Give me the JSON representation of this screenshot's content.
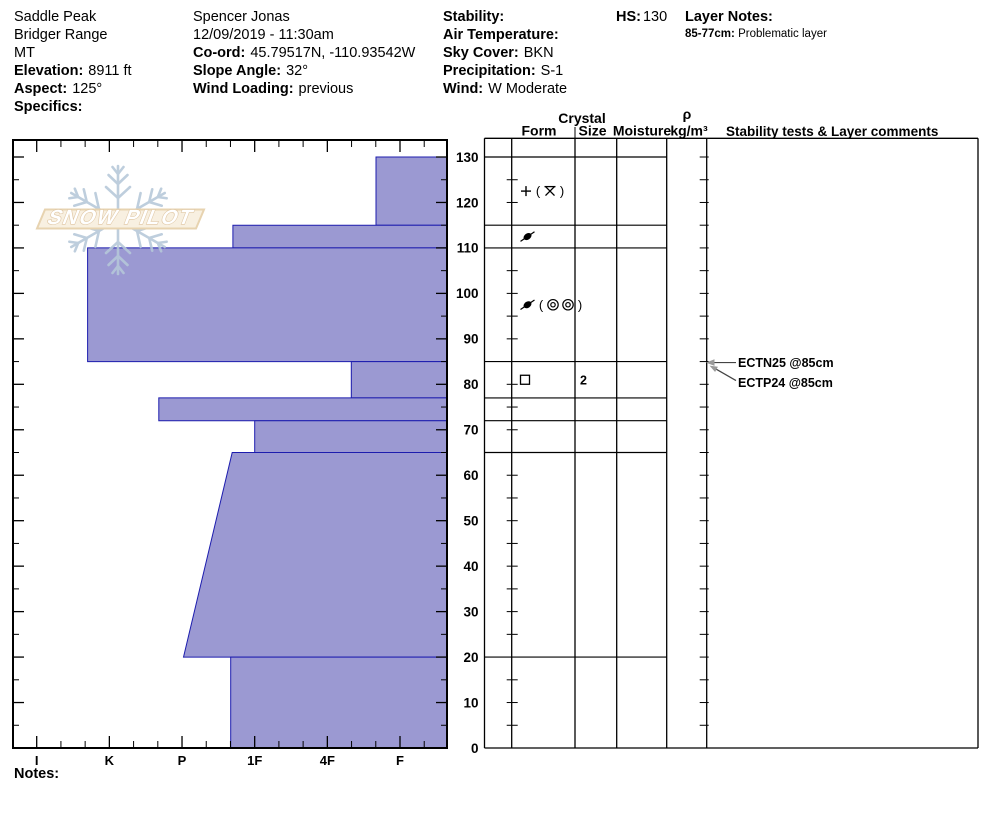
{
  "header": {
    "location": {
      "line1": "Saddle Peak",
      "line2": "Bridger Range",
      "line3": "MT",
      "elevation_label": "Elevation:",
      "elevation_value": "8911 ft",
      "aspect_label": "Aspect:",
      "aspect_value": "125°",
      "specifics_label": "Specifics:",
      "specifics_value": ""
    },
    "observer": {
      "name": "Spencer Jonas",
      "datetime": "12/09/2019 - 11:30am",
      "coord_label": "Co-ord:",
      "coord_value": "45.79517N, -110.93542W",
      "slope_angle_label": "Slope Angle:",
      "slope_angle_value": "32°",
      "wind_loading_label": "Wind Loading:",
      "wind_loading_value": "previous"
    },
    "weather": {
      "stability_label": "Stability:",
      "stability_value": "",
      "air_temp_label": "Air Temperature:",
      "air_temp_value": "",
      "sky_label": "Sky Cover:",
      "sky_value": "BKN",
      "precip_label": "Precipitation:",
      "precip_value": "S-1",
      "wind_label": "Wind:",
      "wind_value": "W Moderate"
    },
    "hs_label": "HS:",
    "hs_value": "130",
    "layer_notes_label": "Layer Notes:",
    "layer_notes": [
      {
        "range": "85-77cm:",
        "text": "Problematic layer"
      }
    ]
  },
  "table": {
    "crystal_header": "Crystal",
    "form_header": "Form",
    "size_header": "Size",
    "moisture_header": "Moisture",
    "rho_symbol": "ρ",
    "rho_units": "kg/m³",
    "stability_header": "Stability tests & Layer comments"
  },
  "watermark": {
    "text": "SNOW PILOT"
  },
  "notes_label": "Notes:",
  "chart_data": {
    "type": "bar",
    "subtype": "snow-profile-hardness",
    "title": "Snow pit hardness profile, total depth HS 130 cm",
    "depth_axis": {
      "unit": "cm",
      "min": 0,
      "max": 130,
      "major_step": 10,
      "minor_step": 5,
      "tick_labels": [
        0,
        10,
        20,
        30,
        40,
        50,
        60,
        70,
        80,
        90,
        100,
        110,
        120,
        130
      ]
    },
    "hardness_axis": {
      "categories": [
        "I",
        "K",
        "P",
        "1F",
        "4F",
        "F"
      ],
      "note": "hand hardness, hard (I) at left to soft (F) at right; bars extend left from right edge"
    },
    "bar_fill": "#9b99d2",
    "bar_stroke": "#1c1cae",
    "layers": [
      {
        "top_cm": 130,
        "bottom_cm": 115,
        "hardness": "F+",
        "hardness_index": 1.33
      },
      {
        "top_cm": 115,
        "bottom_cm": 110,
        "hardness": "1F+",
        "hardness_index": 3.3
      },
      {
        "top_cm": 110,
        "bottom_cm": 85,
        "hardness": "K+",
        "hardness_index": 5.3
      },
      {
        "top_cm": 85,
        "bottom_cm": 77,
        "hardness": "4F-",
        "hardness_index": 1.67
      },
      {
        "top_cm": 77,
        "bottom_cm": 72,
        "hardness": "P+",
        "hardness_index": 4.32
      },
      {
        "top_cm": 72,
        "bottom_cm": 65,
        "hardness": "1F",
        "hardness_index": 3.0
      },
      {
        "top_cm": 65,
        "bottom_cm": 20,
        "hardness": "1F+ to P",
        "hardness_index": 3.31,
        "hardness_index_bottom": 3.98
      },
      {
        "top_cm": 20,
        "bottom_cm": 0,
        "hardness": "1F+",
        "hardness_index": 3.33
      }
    ],
    "grain_forms": [
      {
        "layer_top": 130,
        "layer_bottom": 115,
        "form": "PP (stellar)",
        "symbols": [
          "plus",
          "lparen",
          "xbar",
          "rparen"
        ],
        "size_mm": ""
      },
      {
        "layer_top": 115,
        "layer_bottom": 110,
        "form": "DF",
        "symbols": [
          "df"
        ],
        "size_mm": ""
      },
      {
        "layer_top": 110,
        "layer_bottom": 85,
        "form": "DF (MF)",
        "symbols": [
          "df",
          "lparen",
          "mf",
          "mf",
          "rparen"
        ],
        "size_mm": ""
      },
      {
        "layer_top": 85,
        "layer_bottom": 77,
        "form": "FC faceted crystals",
        "symbols": [
          "fc"
        ],
        "size_mm": "2"
      }
    ],
    "stability_tests": [
      {
        "label": "ECTN25 @85cm",
        "depth_cm": 85,
        "arrow": "horizontal"
      },
      {
        "label": "ECTP24 @85cm",
        "depth_cm": 85,
        "arrow": "diagonal"
      }
    ]
  }
}
